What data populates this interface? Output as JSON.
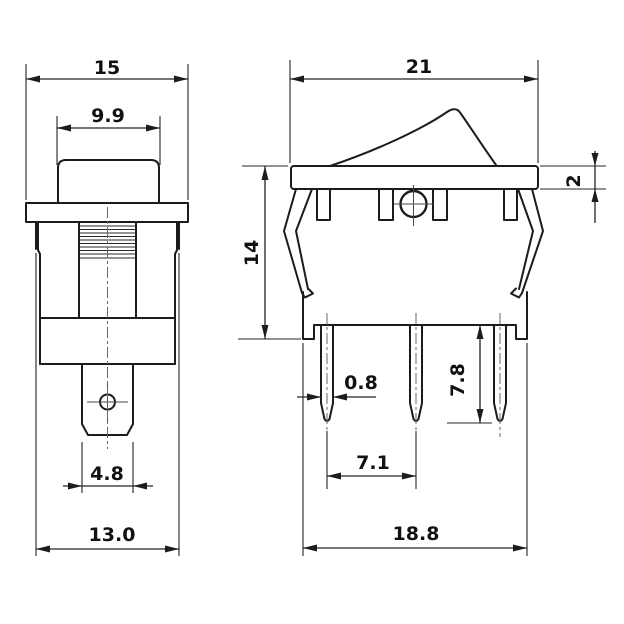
{
  "drawing": {
    "type": "technical-dimension-drawing",
    "subject": "rocker switch, front view and side view",
    "units": "mm",
    "line_color": "#1c1c1c",
    "background": "#ffffff",
    "dims": {
      "front": {
        "flange_width": "15",
        "button_width": "9.9",
        "terminal_width": "4.8",
        "body_width": "13.0"
      },
      "side": {
        "overall_width": "21",
        "bezel_thickness": "2",
        "height": "14",
        "pin_thickness": "0.8",
        "pin_length": "7.8",
        "pin_spacing": "7.1",
        "body_width": "18.8"
      }
    }
  }
}
